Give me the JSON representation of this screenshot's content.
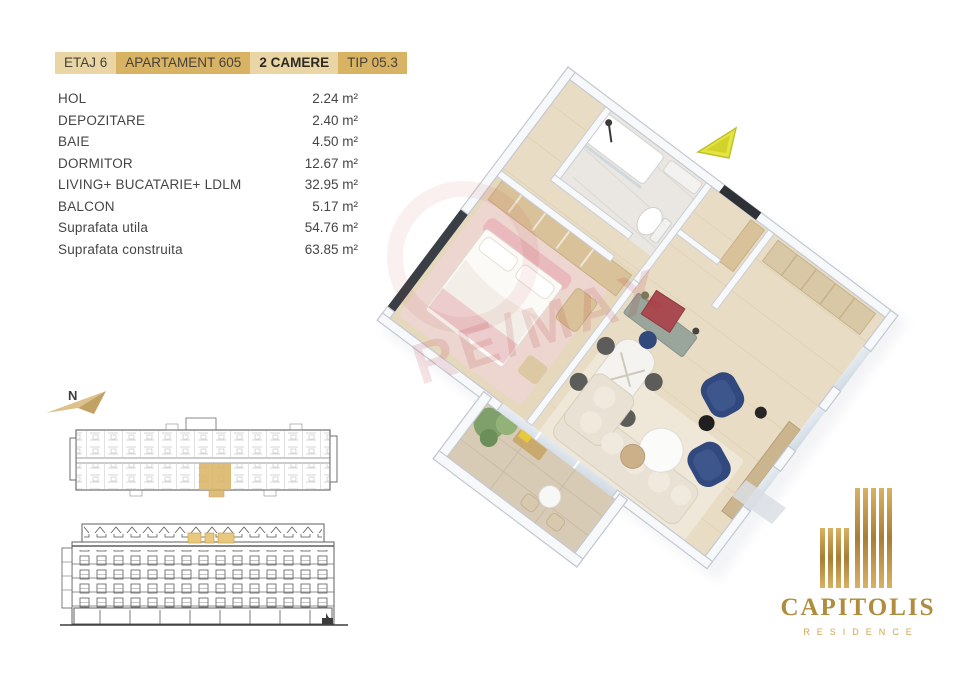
{
  "header": {
    "tags": [
      {
        "label": "ETAJ 6"
      },
      {
        "label": "APARTAMENT 605"
      },
      {
        "label": "2 CAMERE"
      },
      {
        "label": "TIP 05.3"
      }
    ]
  },
  "areas": {
    "rows": [
      {
        "label": "HOL",
        "value": "2.24 m²"
      },
      {
        "label": "DEPOZITARE",
        "value": "2.40 m²"
      },
      {
        "label": "BAIE",
        "value": "4.50 m²"
      },
      {
        "label": "DORMITOR",
        "value": "12.67 m²"
      },
      {
        "label": "LIVING+ BUCATARIE+ LDLM",
        "value": "32.95 m²"
      },
      {
        "label": "BALCON",
        "value": "5.17 m²"
      },
      {
        "label": "Suprafata utila",
        "value": "54.76 m²"
      },
      {
        "label": "Suprafata construita",
        "value": "63.85 m²"
      }
    ]
  },
  "compass": {
    "label": "N"
  },
  "watermark": {
    "text": "RE/MAX"
  },
  "logo": {
    "title": "CAPITOLIS",
    "subtitle": "RESIDENCE"
  },
  "colors": {
    "gold": "#d9b364",
    "gold-light": "#e9d6a4",
    "highlight": "#d9b566",
    "logo-gold": "#b08c3f",
    "navy": "#31497e",
    "wm-red": "#b5252f"
  }
}
